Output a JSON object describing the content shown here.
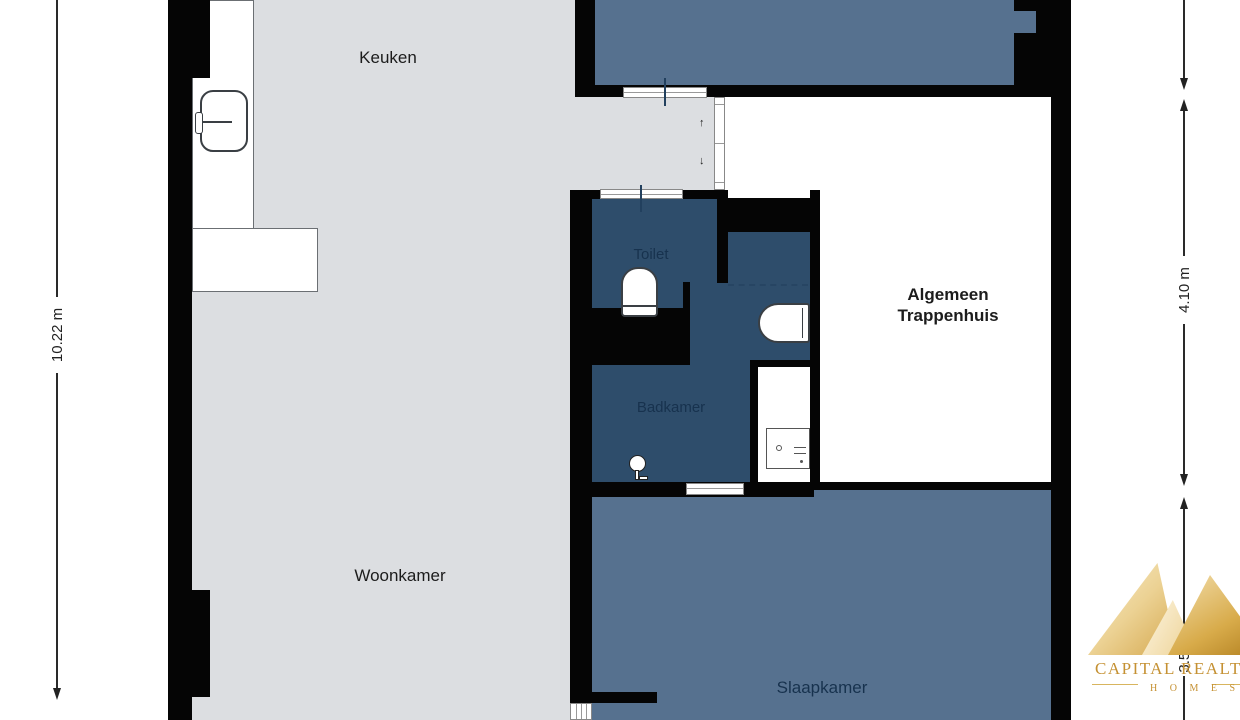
{
  "title": "Apartment floor plan",
  "rooms": {
    "keuken": "Keuken",
    "woonkamer": "Woonkamer",
    "toilet": "Toilet",
    "badkamer": "Badkamer",
    "slaapkamer": "Slaapkamer",
    "trappenhuis_line1": "Algemeen",
    "trappenhuis_line2": "Trappenhuis"
  },
  "dimensions": {
    "left_height": "10.22 m",
    "right_upper": "4.10 m",
    "right_lower": "3.53"
  },
  "hall_arrows": {
    "up": "↑",
    "down": "↓"
  },
  "fixtures": {
    "kitchen_sink": "kitchen-sink",
    "toilet_bowl": "toilet-bowl",
    "wash_basin": "wash-basin",
    "shower_head": "shower-head",
    "washing_machine": "washing-machine"
  },
  "watermark": {
    "line1": "CAPITAL REALTY",
    "line2": "H O M E S"
  },
  "colors": {
    "floor_gray": "#dcdee1",
    "room_slate": "#56718f",
    "room_dark_blue": "#2e4d6b",
    "wall_black": "#050505",
    "label_navy": "#17324e",
    "watermark_gold": "#c59133"
  }
}
